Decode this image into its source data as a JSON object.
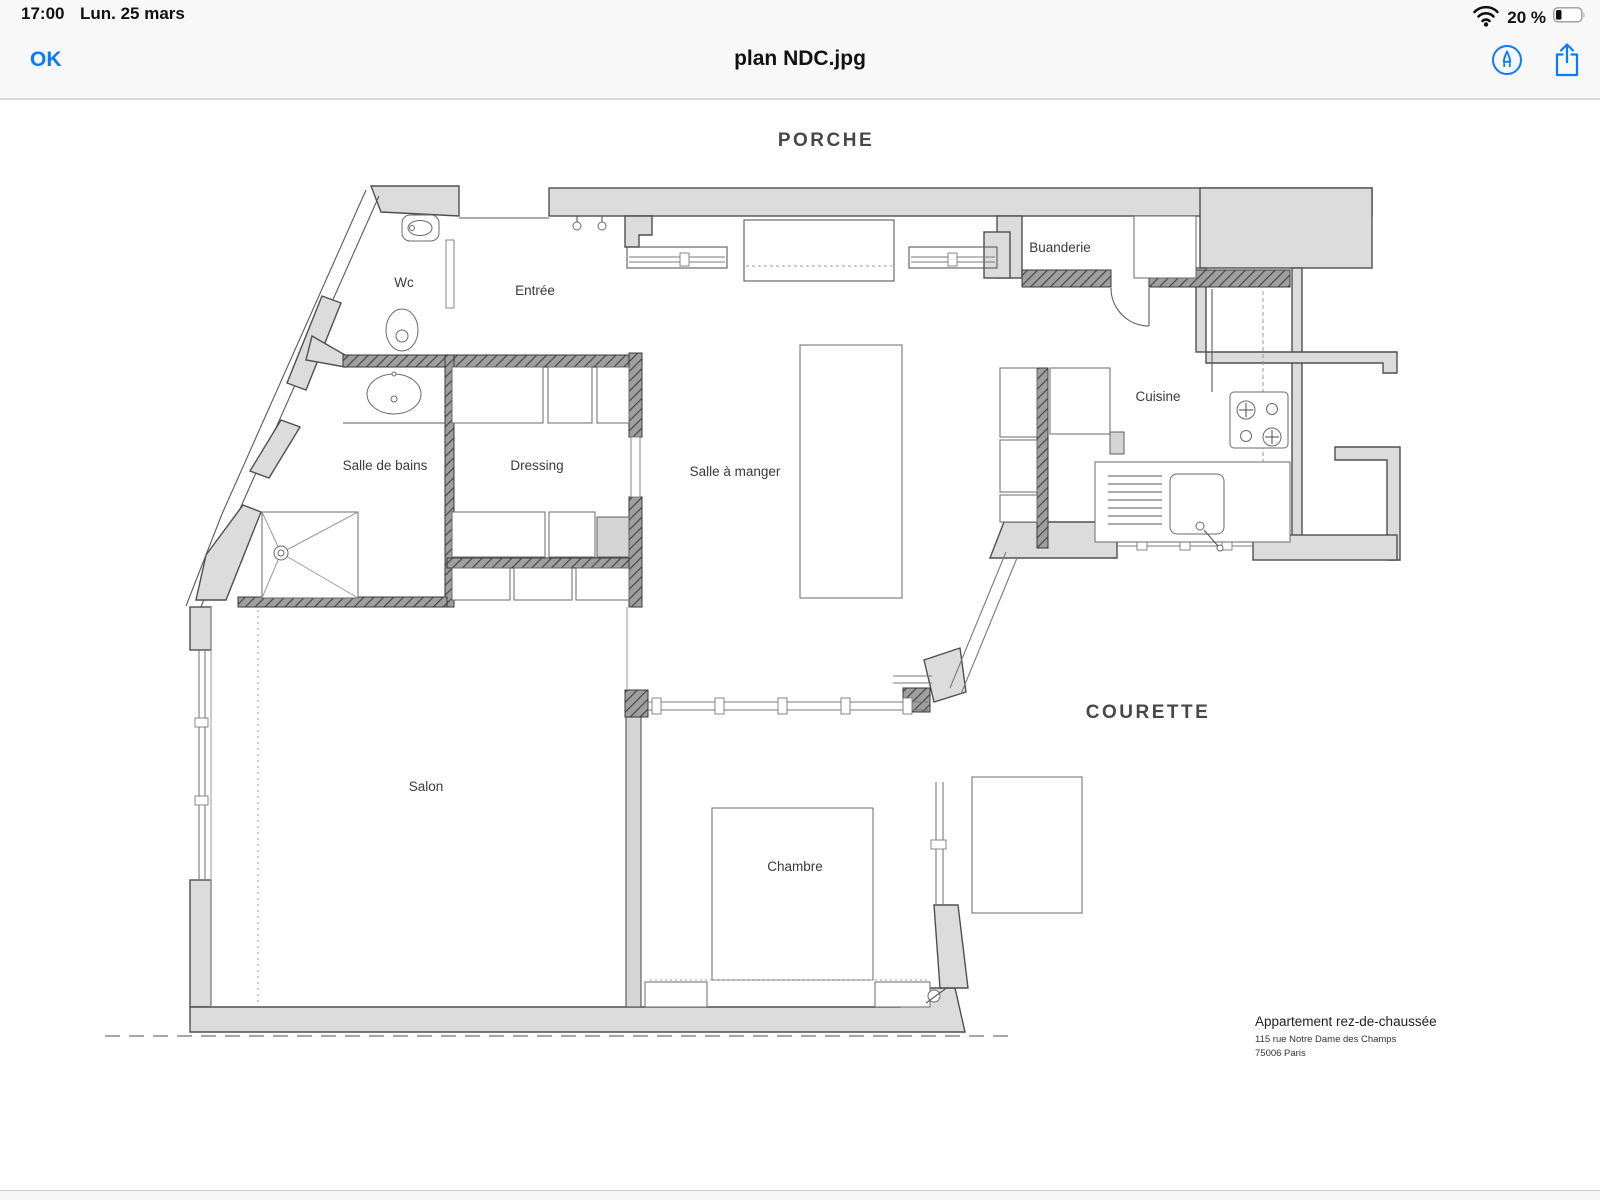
{
  "status_bar": {
    "time": "17:00",
    "date": "Lun. 25 mars",
    "battery_percent": "20 %"
  },
  "nav_bar": {
    "done_button": "OK",
    "title": "plan NDC.jpg"
  },
  "plan": {
    "zone_labels": {
      "porche": "PORCHE",
      "courette": "COURETTE"
    },
    "room_labels": {
      "wc": "Wc",
      "entree": "Entrée",
      "buanderie": "Buanderie",
      "salle_de_bains": "Salle de bains",
      "dressing": "Dressing",
      "salle_a_manger": "Salle à manger",
      "cuisine": "Cuisine",
      "salon": "Salon",
      "chambre": "Chambre"
    },
    "caption": {
      "title": "Appartement rez-de-chaussée",
      "address_line1": "115 rue Notre Dame des Champs",
      "address_line2": "75006   Paris"
    }
  },
  "colors": {
    "accent": "#0a7aff",
    "wall_light": "#dcdcdc",
    "wall_dark": "#6f6f6f",
    "chrome_bg": "#f8f8f8"
  }
}
